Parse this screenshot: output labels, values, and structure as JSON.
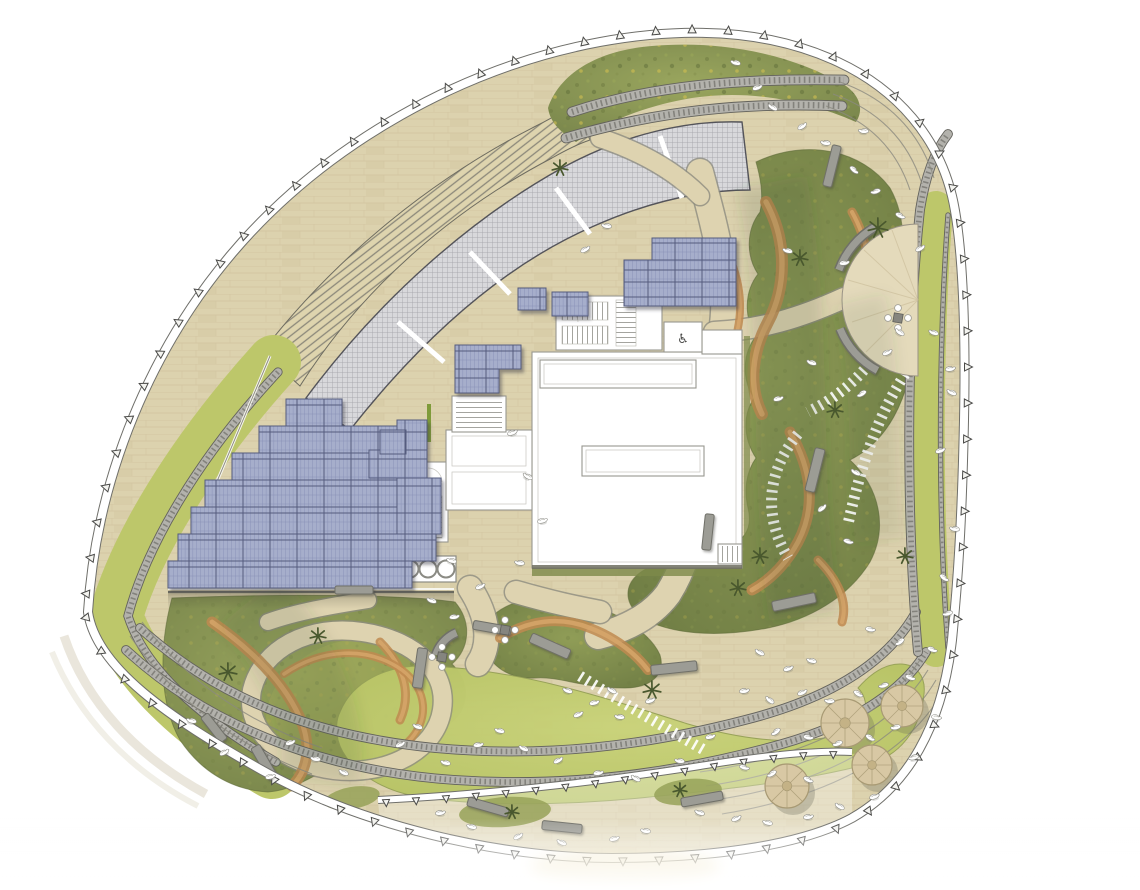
{
  "canvas": {
    "width": 1140,
    "height": 890
  },
  "icons": {
    "accessible": "♿"
  },
  "palette": {
    "deck": "#dcd2ae",
    "deck_light": "#e6ddc1",
    "plank": "#c9bc96",
    "louvre": "#ded4ae",
    "louvre_line": "#8b887a",
    "array_fill": "#d8d8db",
    "array_grid": "#a6a6ab",
    "array_border": "#54545a",
    "lawn": "#bdc76a",
    "lawn_light": "#cad37b",
    "mound_light": "#9aa65e",
    "mound_dark": "#76834a",
    "mound_edge": "#5f6b3a",
    "soil": "#c08a50",
    "soil_light": "#d8a76b",
    "track_fill": "#b3b2ac",
    "track_tick": "#83827c",
    "track_edge": "#63625c",
    "panel_fill": "#a6aecb",
    "panel_grid": "#8a92b8",
    "panel_border": "#555c7e",
    "building_line": "#98978f",
    "building_inner": "#c6c5bf",
    "bench": "#9c9c95",
    "bench_edge": "#6f6f68",
    "canopy": "#d8c8a4",
    "canopy_line": "#a89a74",
    "palm": "#49582e",
    "bird": "#ffffff",
    "bird_edge": "#8e8e88",
    "boundary_line": "#4a4a48",
    "tick_fill": "#f4f4f0",
    "white": "#ffffff"
  },
  "boundary": {
    "segments": [
      {
        "id": "outerPath",
        "spacing": 36,
        "size": 8,
        "flip": false,
        "offset": 18
      },
      {
        "id": "innerBand",
        "spacing": 30,
        "size": 7,
        "flip": true,
        "offset": 8
      }
    ]
  },
  "panels": {
    "stepped_main": [
      [
        286,
        399,
        56,
        27
      ],
      [
        259,
        426,
        138,
        27
      ],
      [
        232,
        453,
        192,
        27
      ],
      [
        205,
        480,
        232,
        27
      ],
      [
        191,
        507,
        250,
        27
      ],
      [
        178,
        534,
        258,
        27
      ],
      [
        168,
        561,
        244,
        27
      ]
    ],
    "stepped_east": [
      [
        397,
        420,
        30,
        30
      ],
      [
        369,
        450,
        58,
        28
      ],
      [
        397,
        478,
        44,
        56
      ]
    ],
    "north_upper": [
      [
        652,
        238,
        84,
        22
      ],
      [
        624,
        260,
        112,
        22
      ],
      [
        624,
        282,
        112,
        24
      ]
    ],
    "roof_west": [
      [
        455,
        345,
        66,
        24
      ],
      [
        455,
        369,
        44,
        24
      ]
    ],
    "roof_top": [
      [
        552,
        292,
        36,
        24
      ],
      [
        518,
        288,
        28,
        22
      ],
      [
        380,
        430,
        26,
        24
      ]
    ]
  },
  "vents": {
    "x": 378,
    "y": 556,
    "w": 78,
    "h": 26,
    "r": 8.5,
    "count": 4,
    "cy": 569,
    "cx0": 392,
    "dx": 18
  },
  "benches": [
    [
      815,
      470,
      10,
      44,
      14
    ],
    [
      708,
      532,
      9,
      36,
      6
    ],
    [
      794,
      602,
      44,
      10,
      -12
    ],
    [
      674,
      668,
      46,
      10,
      -6
    ],
    [
      550,
      646,
      42,
      10,
      24
    ],
    [
      492,
      628,
      38,
      9,
      10
    ],
    [
      420,
      668,
      10,
      40,
      8
    ],
    [
      264,
      762,
      10,
      36,
      -30
    ],
    [
      214,
      728,
      9,
      32,
      -38
    ],
    [
      354,
      590,
      38,
      8,
      0
    ],
    [
      488,
      807,
      42,
      9,
      16
    ],
    [
      562,
      827,
      40,
      9,
      6
    ],
    [
      702,
      799,
      42,
      9,
      -10
    ],
    [
      832,
      166,
      9,
      42,
      14
    ]
  ],
  "arc_benches": [
    [
      916,
      298,
      82,
      118,
      158
    ],
    [
      916,
      298,
      82,
      200,
      240
    ],
    [
      470,
      666,
      36,
      198,
      248
    ]
  ],
  "trees": [
    [
      845,
      723,
      24
    ],
    [
      902,
      706,
      21
    ],
    [
      787,
      786,
      22
    ],
    [
      872,
      765,
      20
    ]
  ],
  "palms": [
    [
      878,
      228,
      10
    ],
    [
      800,
      258,
      8
    ],
    [
      652,
      690,
      9
    ],
    [
      738,
      588,
      8
    ],
    [
      228,
      672,
      9
    ],
    [
      318,
      636,
      8
    ],
    [
      560,
      168,
      8
    ],
    [
      760,
      556,
      8
    ],
    [
      905,
      556,
      8
    ],
    [
      835,
      410,
      8
    ],
    [
      512,
      812,
      7
    ],
    [
      680,
      790,
      7
    ]
  ],
  "chair_groups": [
    [
      442,
      657
    ],
    [
      505,
      630
    ],
    [
      898,
      318
    ]
  ],
  "birds": [
    [
      737,
      63,
      15
    ],
    [
      756,
      88,
      -20
    ],
    [
      774,
      108,
      30
    ],
    [
      801,
      127,
      -35
    ],
    [
      827,
      143,
      10
    ],
    [
      853,
      169,
      40
    ],
    [
      877,
      191,
      -15
    ],
    [
      899,
      215,
      25
    ],
    [
      865,
      131,
      5
    ],
    [
      919,
      249,
      -30
    ],
    [
      935,
      333,
      20
    ],
    [
      949,
      369,
      -10
    ],
    [
      901,
      333,
      35
    ],
    [
      886,
      353,
      -25
    ],
    [
      608,
      226,
      10
    ],
    [
      584,
      250,
      -30
    ],
    [
      813,
      363,
      20
    ],
    [
      777,
      399,
      -15
    ],
    [
      857,
      473,
      30
    ],
    [
      821,
      509,
      -40
    ],
    [
      789,
      251,
      15
    ],
    [
      843,
      263,
      -10
    ],
    [
      953,
      393,
      25
    ],
    [
      939,
      451,
      -20
    ],
    [
      956,
      529,
      10
    ],
    [
      943,
      577,
      35
    ],
    [
      863,
      393,
      -30
    ],
    [
      847,
      541,
      15
    ],
    [
      949,
      613,
      -15
    ],
    [
      931,
      649,
      20
    ],
    [
      901,
      641,
      -35
    ],
    [
      869,
      629,
      10
    ],
    [
      761,
      653,
      30
    ],
    [
      787,
      669,
      -20
    ],
    [
      813,
      661,
      15
    ],
    [
      743,
      691,
      -10
    ],
    [
      771,
      701,
      40
    ],
    [
      801,
      693,
      -25
    ],
    [
      831,
      701,
      5
    ],
    [
      857,
      693,
      30
    ],
    [
      885,
      685,
      -15
    ],
    [
      909,
      677,
      20
    ],
    [
      777,
      731,
      -35
    ],
    [
      807,
      737,
      10
    ],
    [
      839,
      743,
      -20
    ],
    [
      869,
      737,
      30
    ],
    [
      897,
      727,
      -10
    ],
    [
      743,
      767,
      15
    ],
    [
      773,
      773,
      -30
    ],
    [
      807,
      779,
      25
    ],
    [
      915,
      757,
      -15
    ],
    [
      935,
      717,
      10
    ],
    [
      701,
      813,
      20
    ],
    [
      735,
      819,
      -25
    ],
    [
      769,
      823,
      15
    ],
    [
      807,
      817,
      -10
    ],
    [
      841,
      807,
      30
    ],
    [
      873,
      797,
      -20
    ],
    [
      647,
      831,
      10
    ],
    [
      613,
      839,
      -15
    ],
    [
      563,
      843,
      25
    ],
    [
      517,
      837,
      -30
    ],
    [
      473,
      827,
      15
    ],
    [
      439,
      813,
      -10
    ],
    [
      569,
      691,
      20
    ],
    [
      593,
      703,
      -15
    ],
    [
      613,
      691,
      30
    ],
    [
      577,
      715,
      -25
    ],
    [
      621,
      717,
      10
    ],
    [
      649,
      701,
      -20
    ],
    [
      501,
      731,
      15
    ],
    [
      477,
      745,
      -10
    ],
    [
      525,
      749,
      25
    ],
    [
      557,
      761,
      -30
    ],
    [
      681,
      761,
      10
    ],
    [
      709,
      737,
      -15
    ],
    [
      419,
      727,
      20
    ],
    [
      399,
      745,
      -25
    ],
    [
      447,
      763,
      15
    ],
    [
      597,
      773,
      -10
    ],
    [
      637,
      779,
      30
    ],
    [
      289,
      743,
      -20
    ],
    [
      317,
      759,
      10
    ],
    [
      269,
      777,
      -15
    ],
    [
      345,
      773,
      25
    ],
    [
      223,
      753,
      -30
    ],
    [
      193,
      721,
      15
    ],
    [
      453,
      617,
      -10
    ],
    [
      433,
      601,
      20
    ],
    [
      479,
      587,
      -25
    ],
    [
      521,
      563,
      10
    ],
    [
      541,
      521,
      -15
    ],
    [
      529,
      477,
      30
    ],
    [
      511,
      433,
      -20
    ],
    [
      453,
      561,
      15
    ]
  ]
}
